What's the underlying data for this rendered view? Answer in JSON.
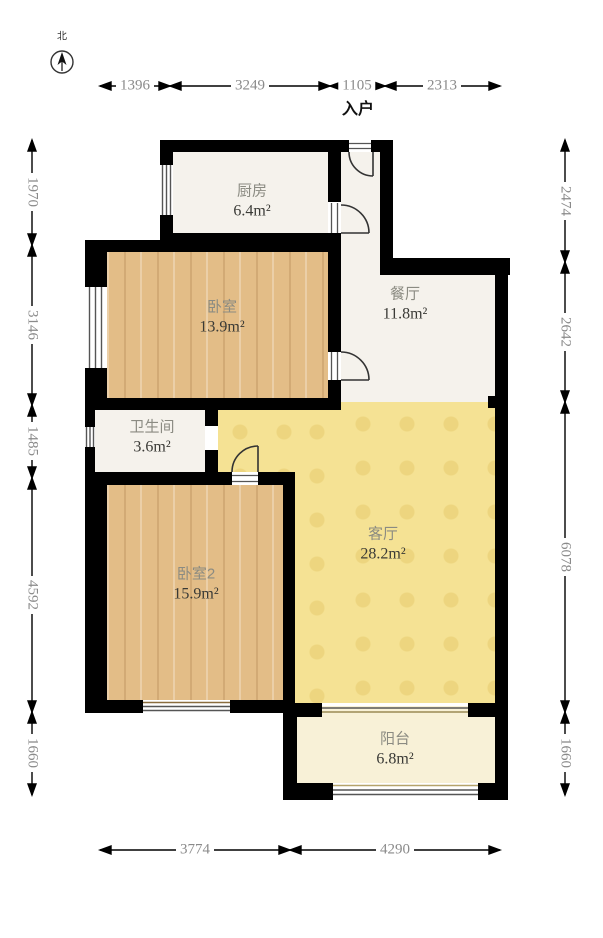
{
  "plan_title": "residential floor plan",
  "compass": {
    "north_label": "北"
  },
  "entrance": {
    "label": "入户"
  },
  "rooms": [
    {
      "id": "kitchen",
      "name": "厨房",
      "area": "6.4m²"
    },
    {
      "id": "dining",
      "name": "餐厅",
      "area": "11.8m²"
    },
    {
      "id": "bedroom1",
      "name": "卧室",
      "area": "13.9m²"
    },
    {
      "id": "bathroom",
      "name": "卫生间",
      "area": "3.6m²"
    },
    {
      "id": "bedroom2",
      "name": "卧室2",
      "area": "15.9m²"
    },
    {
      "id": "living",
      "name": "客厅",
      "area": "28.2m²"
    },
    {
      "id": "balcony",
      "name": "阳台",
      "area": "6.8m²"
    }
  ],
  "dimensions": {
    "top": [
      "1396",
      "3249",
      "1105",
      "2313"
    ],
    "left": [
      "1970",
      "3146",
      "1485",
      "4592",
      "1660"
    ],
    "right": [
      "2474",
      "2642",
      "6078",
      "1660"
    ],
    "bottom": [
      "3774",
      "4290"
    ]
  },
  "colors": {
    "wall": "#000000",
    "wood_floor": "#e3bd87",
    "living_floor": "#f5e294",
    "marble_floor": "#f5f2ec",
    "balcony_floor": "#f8f1d7",
    "dimension_text": "#8a8a8a"
  }
}
